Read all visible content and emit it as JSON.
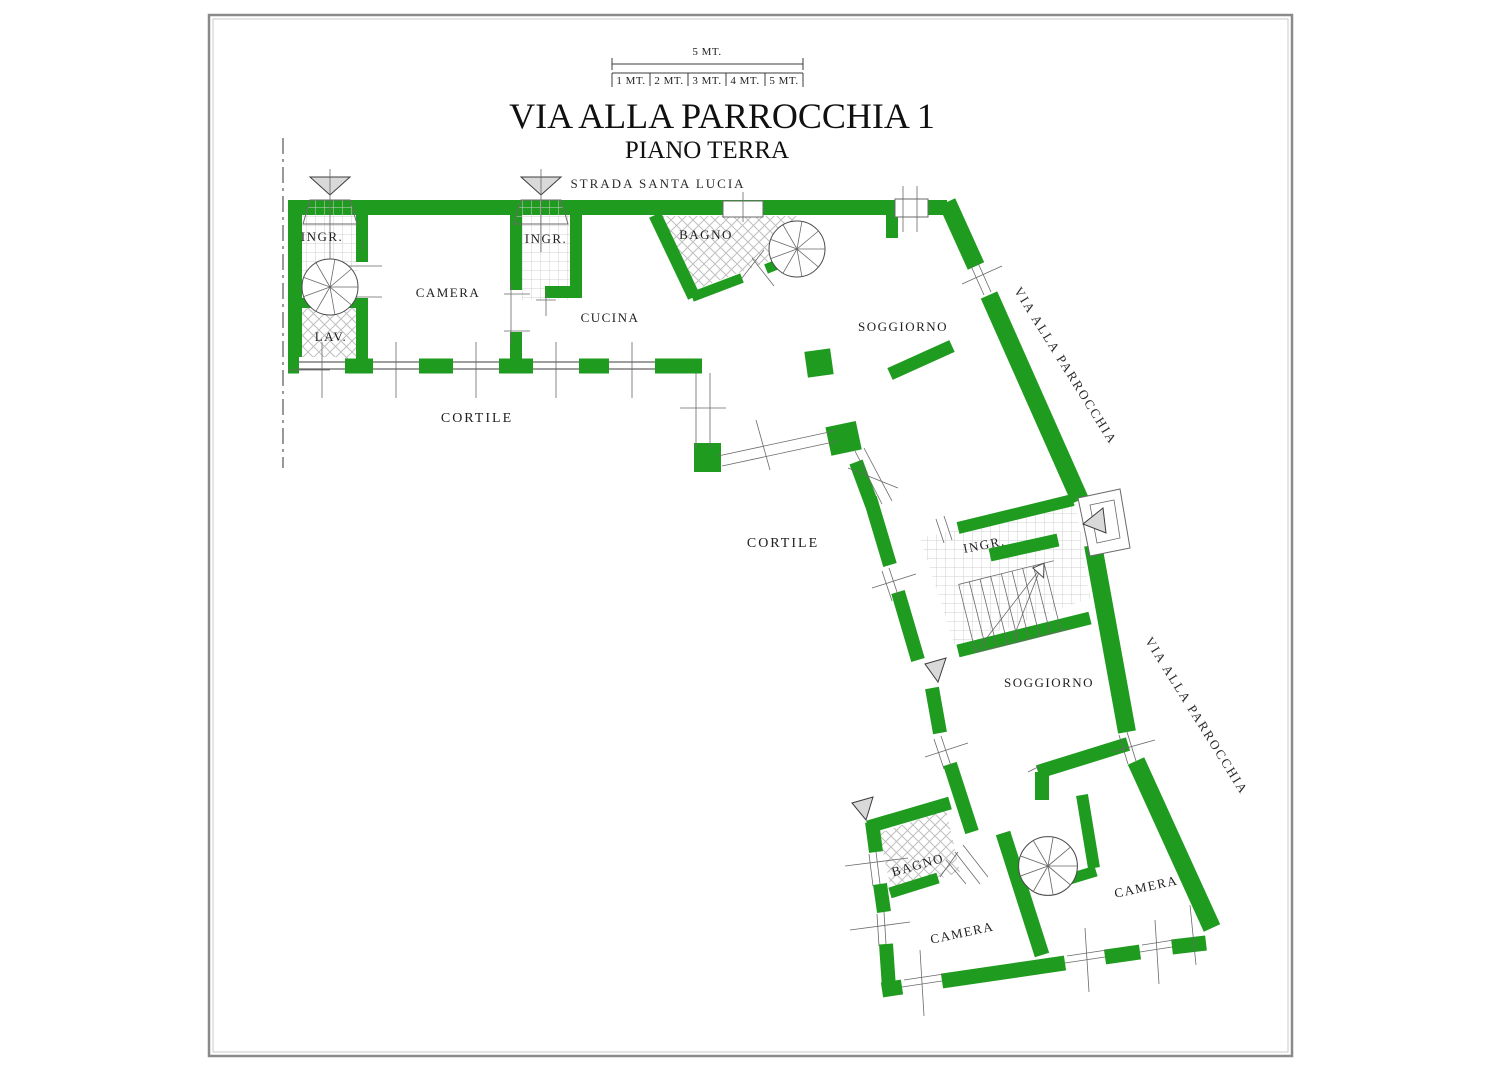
{
  "colors": {
    "wall": "#1F9C1F",
    "line": "#3C3C3C",
    "funnel": "#D9D9D9",
    "text": "#1F1F1F",
    "frame": "#8A8A8A"
  },
  "header": {
    "title": "VIA ALLA PARROCCHIA 1",
    "subtitle": "PIANO TERRA",
    "scale_total": "5 MT.",
    "scale_segments": [
      "1 MT.",
      "2 MT.",
      "3 MT.",
      "4 MT.",
      "5 MT."
    ]
  },
  "streets": {
    "top": "STRADA SANTA LUCIA",
    "upper_right": "VIA ALLA PARROCCHIA",
    "lower_right": "VIA ALLA PARROCCHIA"
  },
  "outdoor": {
    "courtyard_upper": "CORTILE",
    "courtyard_lower": "CORTILE"
  },
  "rooms": {
    "ingresso_nw": "INGR.",
    "lavanderia": "LAV.",
    "camera_nw": "CAMERA",
    "ingresso_n": "INGR.",
    "cucina": "CUCINA",
    "bagno_n": "BAGNO",
    "soggiorno_n": "SOGGIORNO",
    "ingresso_e": "INGR.",
    "soggiorno_s": "SOGGIORNO",
    "bagno_s": "BAGNO",
    "camera_sw": "CAMERA",
    "camera_se": "CAMERA"
  }
}
